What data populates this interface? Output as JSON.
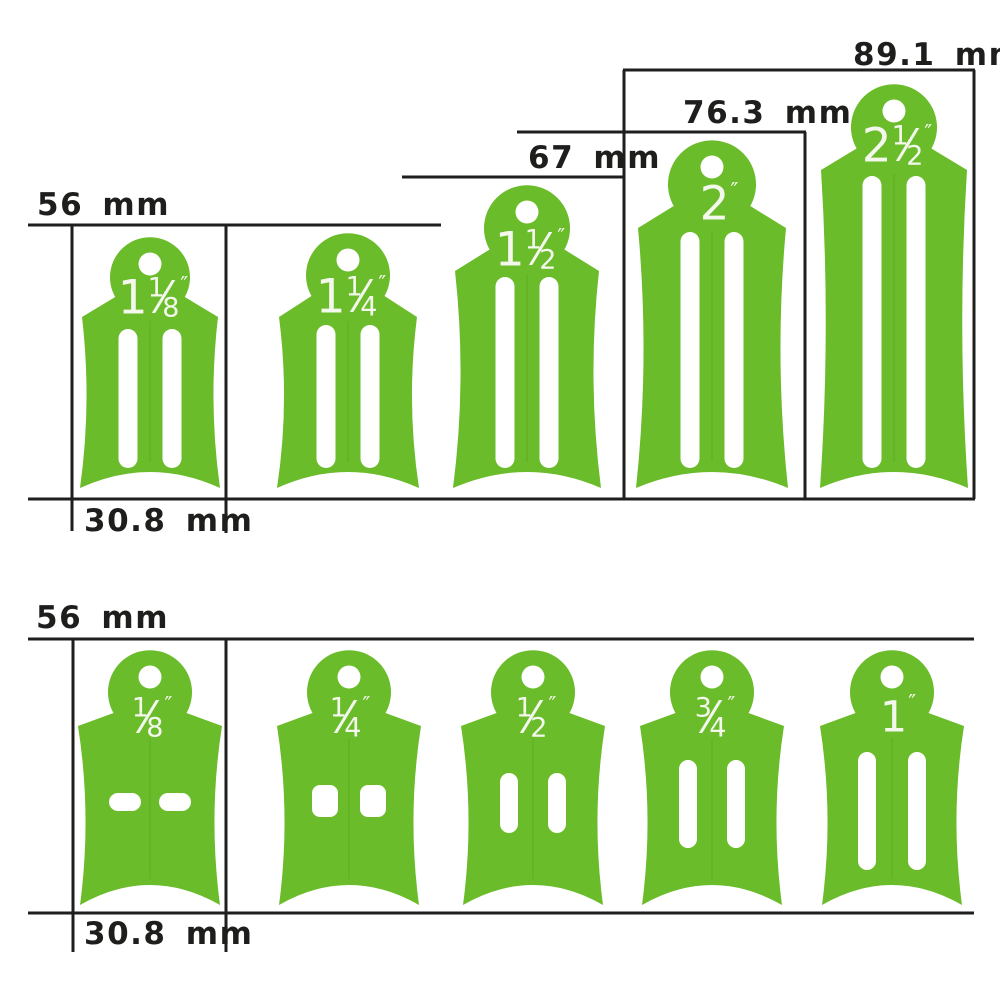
{
  "diagram": {
    "description": "Strap-width buckle size templates with dimensions",
    "top_row": {
      "dim_labels": {
        "height_56": "56 mm",
        "height_67": "67 mm",
        "height_76": "76.3 mm",
        "height_89": "89.1 mm",
        "width_30": "30.8 mm"
      },
      "tags": [
        {
          "whole": "1",
          "num": "1",
          "slash": "⁄",
          "den": "8",
          "unit": "″"
        },
        {
          "whole": "1",
          "num": "1",
          "slash": "⁄",
          "den": "4",
          "unit": "″"
        },
        {
          "whole": "1",
          "num": "1",
          "slash": "⁄",
          "den": "2",
          "unit": "″"
        },
        {
          "whole": "2",
          "num": "",
          "slash": "",
          "den": "",
          "unit": "″"
        },
        {
          "whole": "2",
          "num": "1",
          "slash": "⁄",
          "den": "2",
          "unit": "″"
        }
      ]
    },
    "bottom_row": {
      "dim_labels": {
        "height_56": "56 mm",
        "width_30": "30.8 mm"
      },
      "tags": [
        {
          "whole": "",
          "num": "1",
          "slash": "⁄",
          "den": "8",
          "unit": "″"
        },
        {
          "whole": "",
          "num": "1",
          "slash": "⁄",
          "den": "4",
          "unit": "″"
        },
        {
          "whole": "",
          "num": "1",
          "slash": "⁄",
          "den": "2",
          "unit": "″"
        },
        {
          "whole": "",
          "num": "3",
          "slash": "⁄",
          "den": "4",
          "unit": "″"
        },
        {
          "whole": "1",
          "num": "",
          "slash": "",
          "den": "",
          "unit": "″"
        }
      ]
    },
    "colors": {
      "tag_green": "#6abc2a",
      "seam_green": "#57a31f",
      "line_ink": "#1e1e1c",
      "label_white": "#f3f7ec",
      "background": "#ffffff"
    }
  }
}
